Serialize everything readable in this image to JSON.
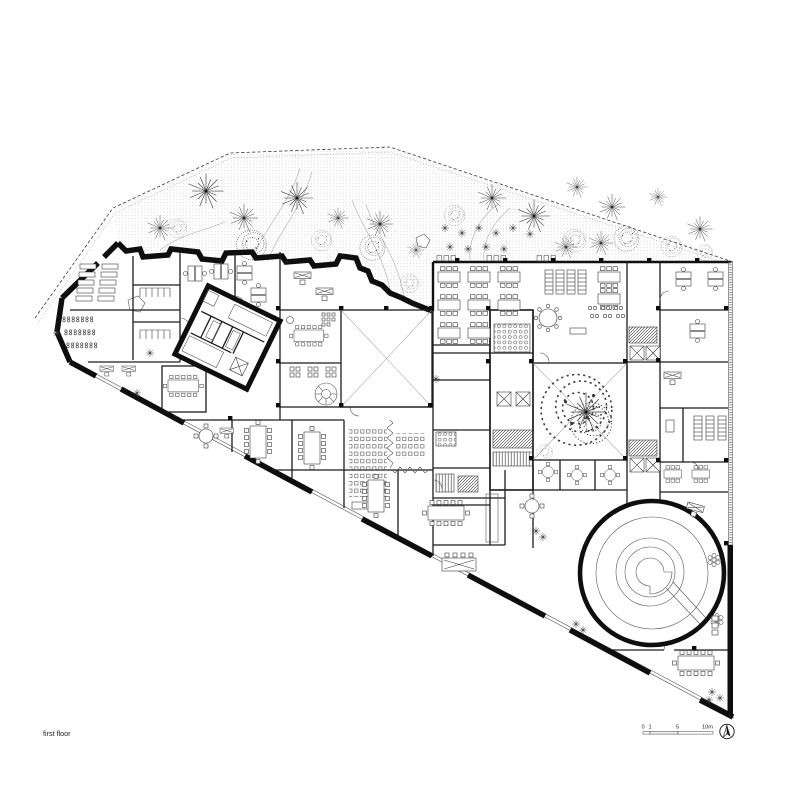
{
  "plan": {
    "floor_label": "first floor",
    "scale_bar": {
      "t0": "0",
      "t1": "1",
      "t5": "5",
      "t10": "10m"
    },
    "north_indicator": "north-arrow",
    "colors": {
      "ink": "#141414",
      "paper": "#ffffff"
    },
    "legend": {
      "drawing_type": "architectural floor plan",
      "features": [
        "garden with trees",
        "jagged perimeter wall",
        "rotated stair core block",
        "skylight atrium",
        "courtyard with tree",
        "circular ramp hall",
        "offices and meeting rooms",
        "canteen seating"
      ]
    }
  }
}
